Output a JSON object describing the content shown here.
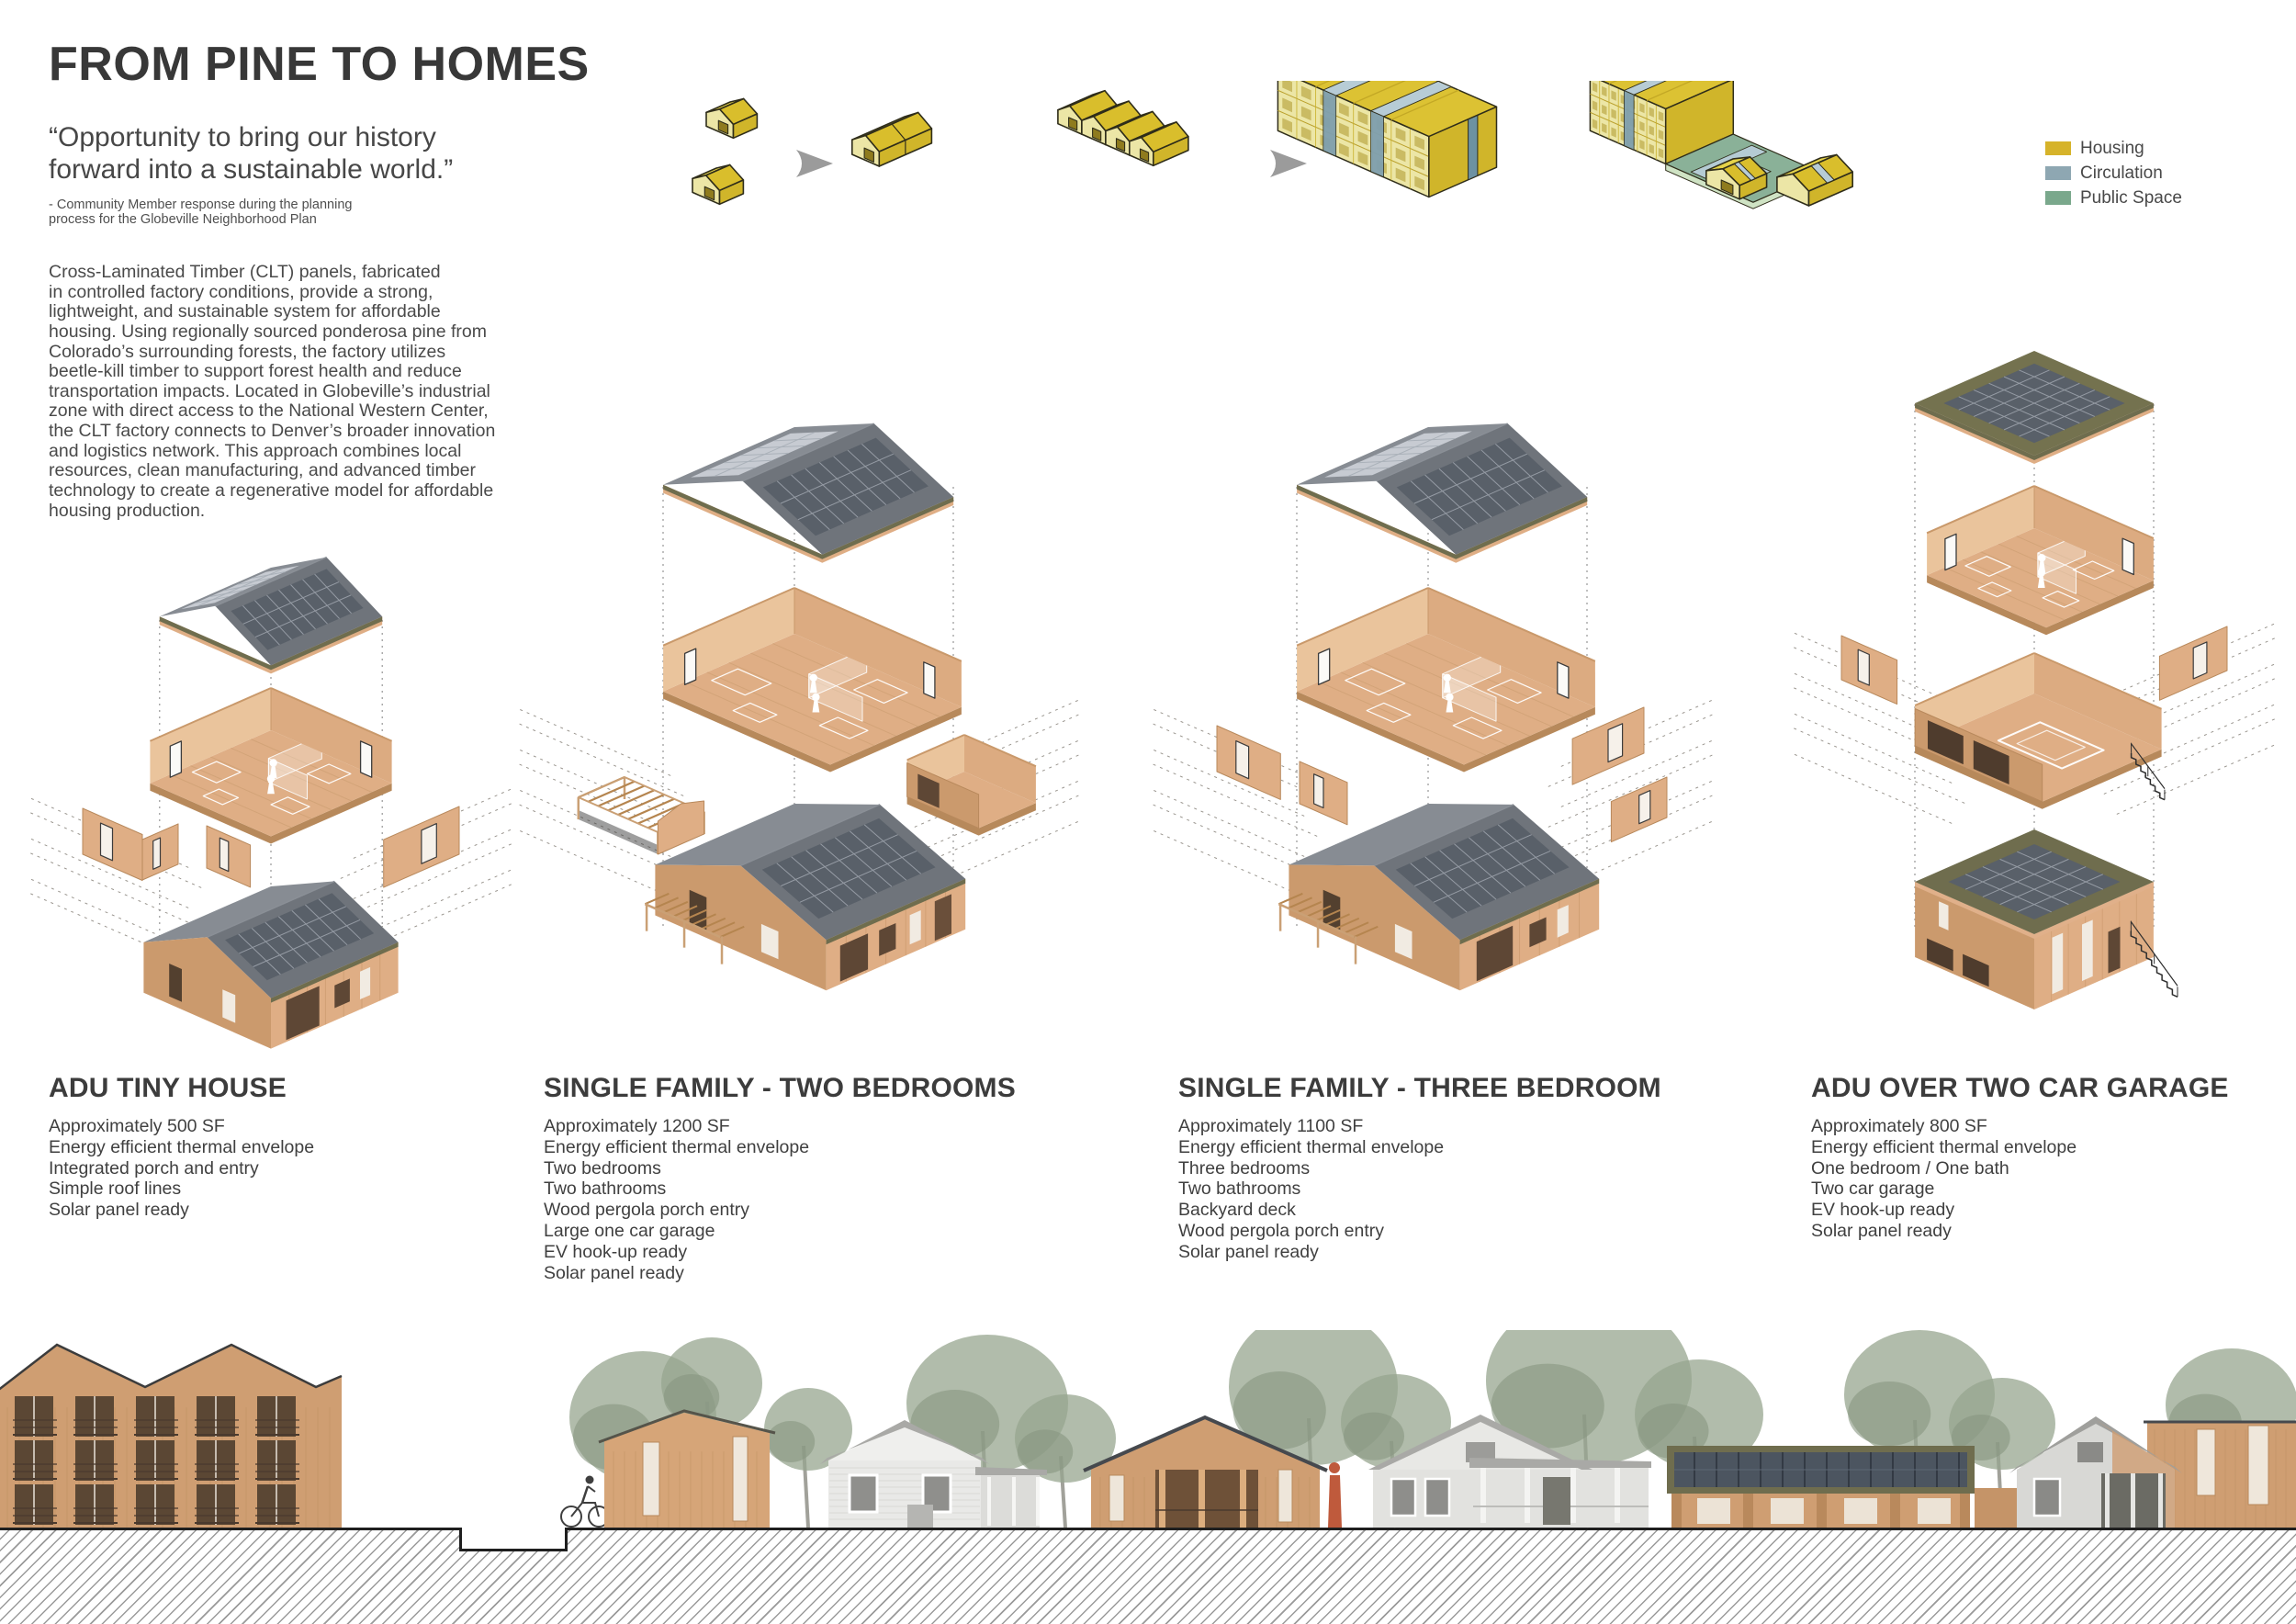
{
  "page": {
    "title": "FROM PINE TO HOMES",
    "quote": "“Opportunity to bring our history\nforward into a sustainable world.”",
    "attribution": "- Community Member response during the planning\nprocess for the Globeville Neighborhood Plan",
    "body": "Cross-Laminated Timber (CLT) panels, fabricated\nin controlled factory conditions, provide a strong,\nlightweight, and sustainable system for affordable\nhousing. Using regionally sourced ponderosa pine from\nColorado’s surrounding forests, the factory utilizes\nbeetle-kill timber to support forest health and reduce\ntransportation impacts. Located in Globeville’s industrial\nzone with direct access to the National Western Center,\nthe CLT factory connects to Denver’s broader innovation\nand logistics network. This approach combines local\nresources, clean manufacturing, and advanced timber\ntechnology to create a regenerative model for affordable\nhousing production."
  },
  "legend": {
    "items": [
      {
        "label": "Housing",
        "color": "#d6b32a"
      },
      {
        "label": "Circulation",
        "color": "#8ea7b2"
      },
      {
        "label": "Public Space",
        "color": "#7aa88c"
      }
    ]
  },
  "massing_sequence": {
    "stages": [
      "two-detached-units",
      "attached-duplex",
      "rowhouse-strip",
      "stacked-housing-block",
      "block-with-circulation-and-public-space"
    ]
  },
  "house_types": [
    {
      "name": "ADU TINY HOUSE",
      "specs": [
        "Approximately 500 SF",
        "Energy efficient thermal envelope",
        "Integrated porch and entry",
        "Simple roof lines",
        "Solar panel ready"
      ]
    },
    {
      "name": "SINGLE FAMILY - TWO BEDROOMS",
      "specs": [
        "Approximately  1200 SF",
        "Energy efficient thermal envelope",
        "Two bedrooms",
        "Two bathrooms",
        "Wood pergola porch entry",
        "Large one car garage",
        "EV hook-up ready",
        "Solar panel ready"
      ]
    },
    {
      "name": "SINGLE FAMILY - THREE BEDROOM",
      "specs": [
        "Approximately  1100 SF",
        "Energy efficient thermal envelope",
        "Three bedrooms",
        "Two bathrooms",
        "Backyard deck",
        "Wood pergola porch entry",
        "Solar panel ready"
      ]
    },
    {
      "name": "ADU OVER TWO CAR GARAGE",
      "specs": [
        "Approximately  800 SF",
        "Energy efficient thermal envelope",
        "One bedroom / One bath",
        "Two car garage",
        "EV hook-up ready",
        "Solar panel ready"
      ]
    }
  ],
  "colors": {
    "ink": "#383838",
    "text": "#4a4a4a",
    "wood": "#dfae85",
    "wood_light": "#ecc9a4",
    "wood_dark": "#cb9a6d",
    "wood_edge": "#b7895b",
    "roof_gray": "#6f747b",
    "roof_gray_light": "#878c93",
    "solar": "#596069",
    "solar_grid": "#959ba4",
    "solar_light": "#c7cbd2",
    "olive": "#6f6d4e",
    "dash": "#8f8a82",
    "mass_yellow_top": "#dcc233",
    "mass_yellow_light": "#ece6a6",
    "mass_yellow_side": "#d0b52a",
    "mass_outline": "#2f2d1a",
    "circ_light": "#b7ccd6",
    "circ": "#7f9fae",
    "green_top": "#8ab198",
    "green_light": "#cfe3c4",
    "arrow": "#9b9b9b",
    "elev_wood": "#cf9e72",
    "elev_wood_line": "#bb8d60",
    "elev_gray": "#a9a9a6",
    "elev_gray_light": "#e9e9e7",
    "tree": "#97a58f",
    "ground_line": "#1f1f1f"
  }
}
